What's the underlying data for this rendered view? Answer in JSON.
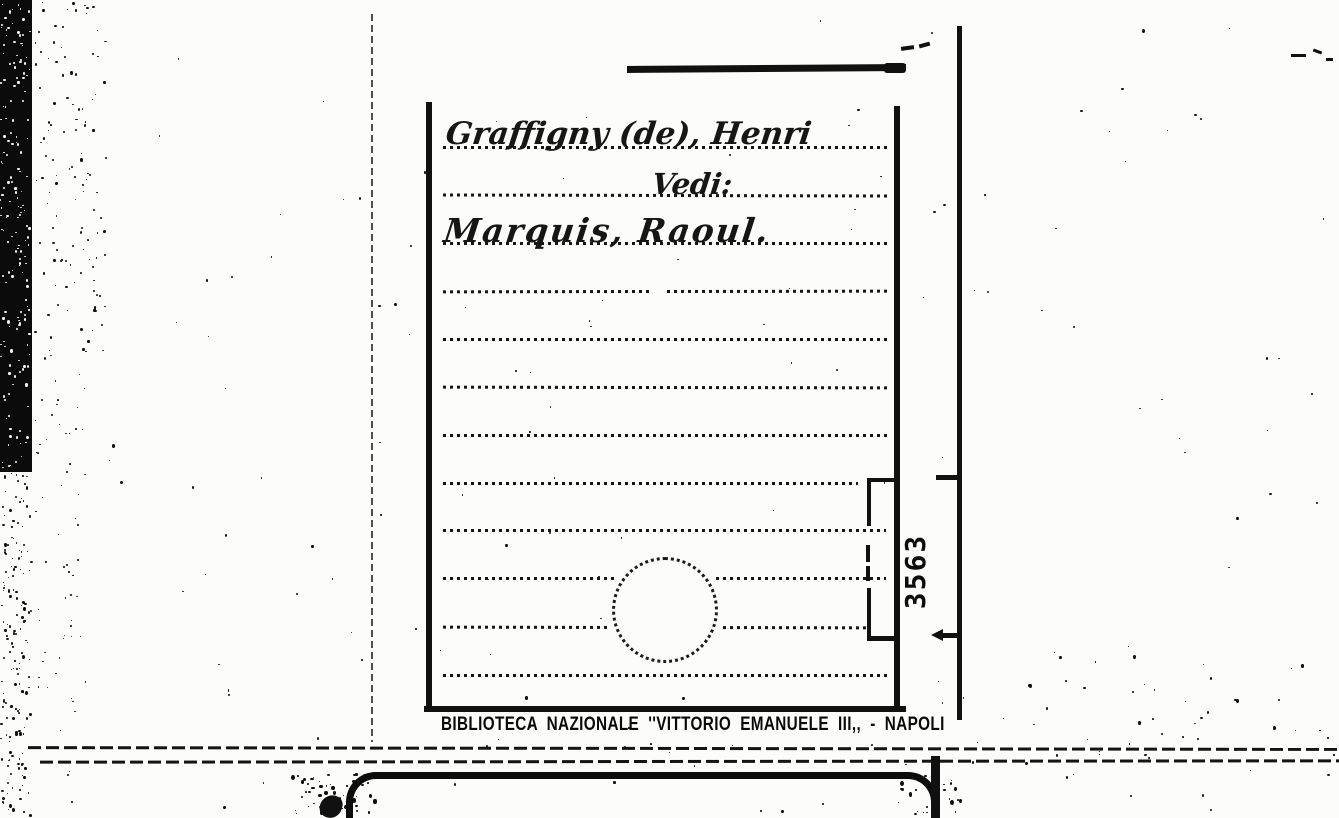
{
  "card": {
    "heading": "Graffigny (de), Henri",
    "cross_reference_label": "Vedi:",
    "see_reference": "Marquis, Raoul.",
    "library_stamp": "BIBLIOTECA NAZIONALE ''VITTORIO EMANUELE III,, - NAPOLI",
    "margin_number": "3563"
  },
  "colors": {
    "ink": "#111111",
    "paper": "#fcfcfa"
  }
}
